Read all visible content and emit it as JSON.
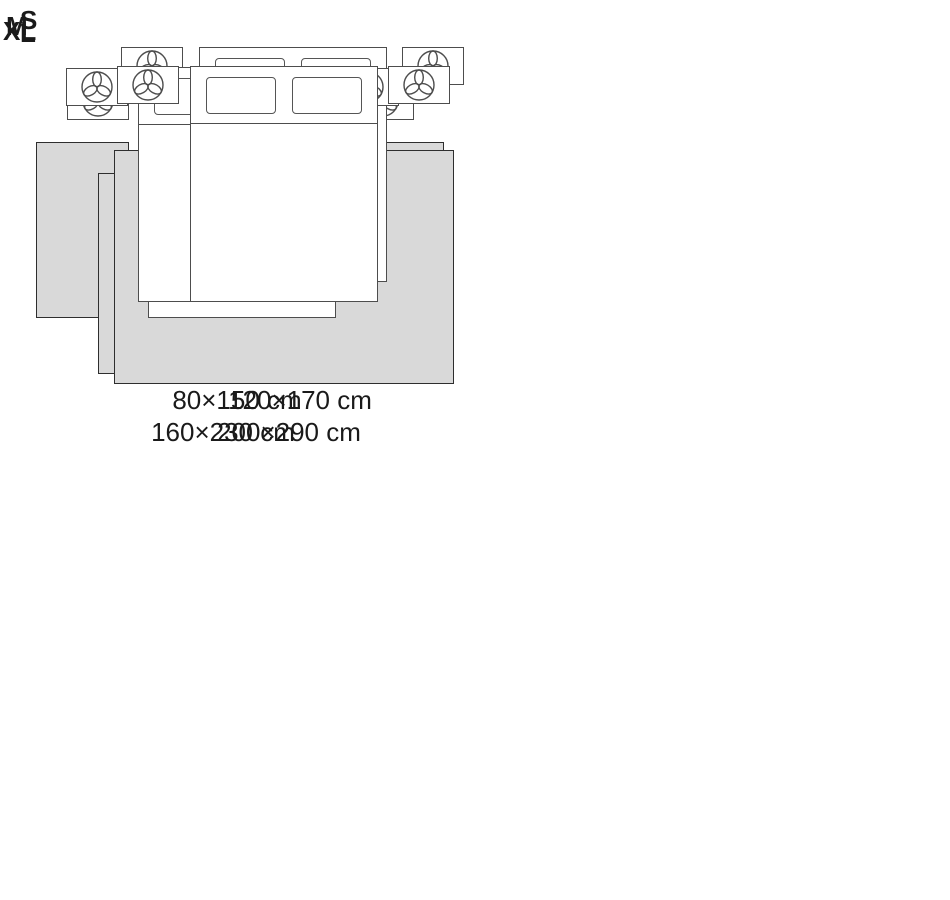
{
  "figure": {
    "kind": "rug-size-guide",
    "background": "#ffffff"
  },
  "options": [
    {
      "label": "S",
      "dimensions": "80×150 cm",
      "layout": "two bedside runners"
    },
    {
      "label": "M",
      "dimensions": "120×170 cm",
      "layout": "rug under foot of bed"
    },
    {
      "label": "L",
      "dimensions": "160×230 cm",
      "layout": "rug under lower two-thirds of bed"
    },
    {
      "label": "XL",
      "dimensions": "200×290 cm",
      "layout": "room-wide rug under bed and beyond nightstands"
    }
  ],
  "icons": {
    "nightstand_icon": "plant-trefoil-icon"
  },
  "colors": {
    "rug_fill": "#d9d9d9",
    "rug_outline": "#2e2e2e",
    "furniture_outline": "#4d4d4d",
    "text": "#1a1a1a"
  }
}
